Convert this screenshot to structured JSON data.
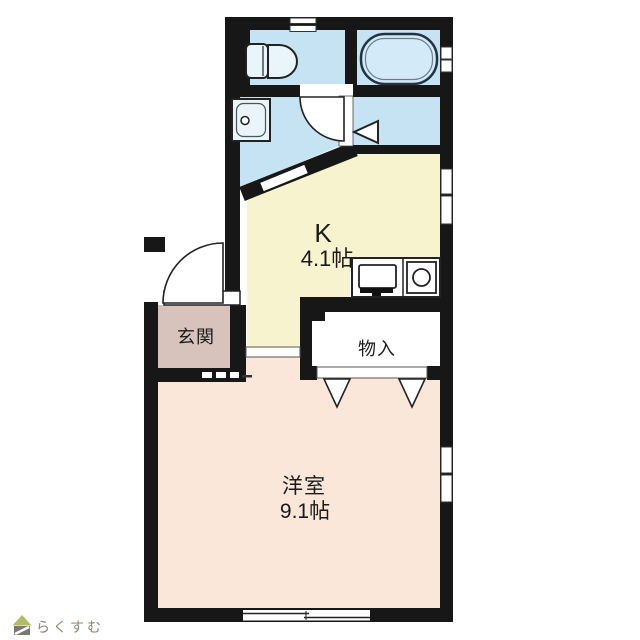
{
  "rooms": {
    "kitchen": {
      "label": "K",
      "area": "4.1帖",
      "color": "#f7f3cf"
    },
    "western_room": {
      "label": "洋室",
      "area": "9.1帖",
      "color": "#fbe7da"
    },
    "entrance": {
      "label": "玄関",
      "color": "#d8c2bc"
    },
    "closet": {
      "label": "物入",
      "color": "#ffffff"
    },
    "toilet": {
      "color": "#c6e3f3"
    },
    "bathroom": {
      "color": "#c6e3f3"
    },
    "washroom": {
      "color": "#c6e3f3"
    },
    "changing_area": {
      "color": "#c6e3f3"
    }
  },
  "fixtures": {
    "bathtub_fill": "#d3eaf8",
    "basin_fill": "#e9f4fb",
    "outline": "#1f1f1f"
  },
  "structure": {
    "wall_color": "#171717",
    "background": "#ffffff"
  },
  "footer": {
    "logo_text": "らくすむ",
    "logo_text_color": "#8d837b",
    "logo_roof_color": "#b2bc62",
    "logo_house_color": "#7d7672"
  }
}
